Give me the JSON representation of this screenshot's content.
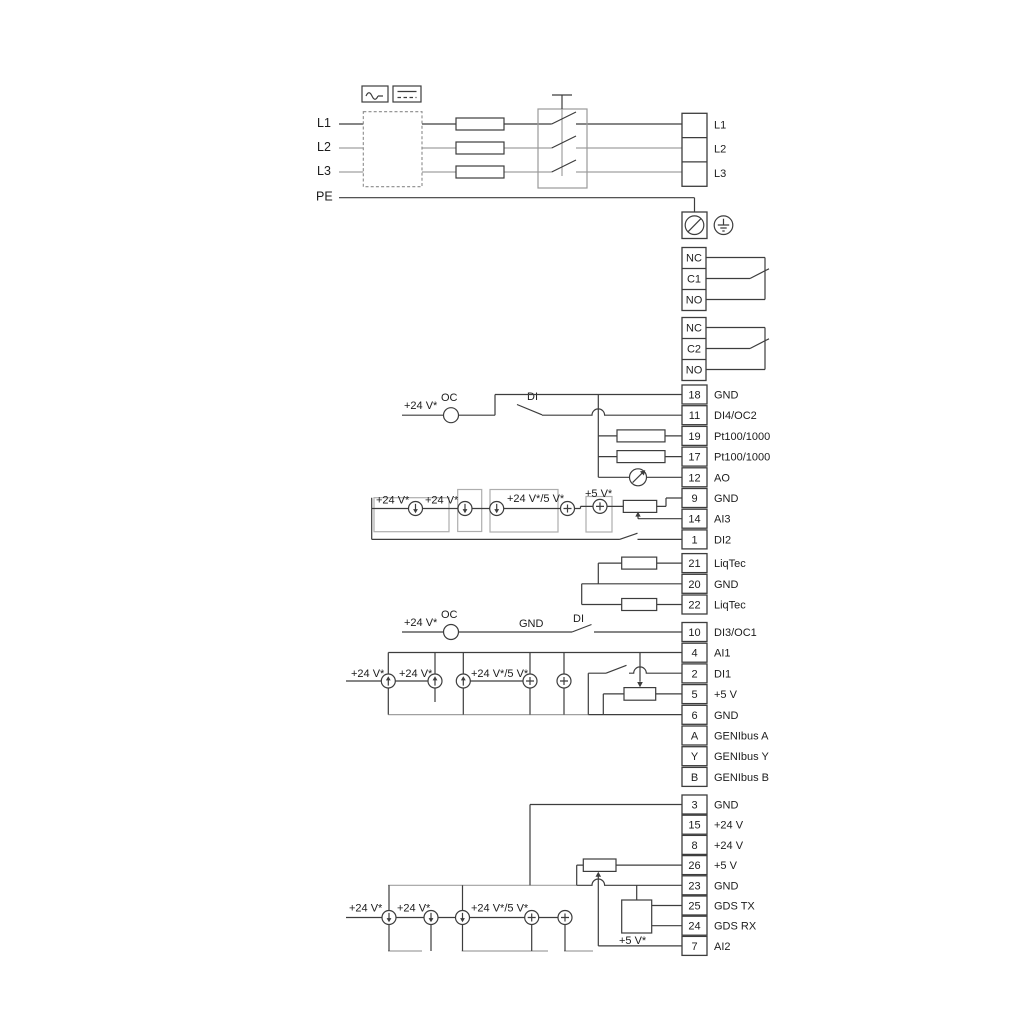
{
  "power": {
    "inputs": [
      "L1",
      "L2",
      "L3",
      "PE"
    ],
    "outputs": [
      "L1",
      "L2",
      "L3"
    ]
  },
  "relays": [
    {
      "t": [
        "NC",
        "C1",
        "NO"
      ]
    },
    {
      "t": [
        "NC",
        "C2",
        "NO"
      ]
    }
  ],
  "terminal_groups": [
    {
      "rows": [
        {
          "num": "18",
          "label": "GND"
        },
        {
          "num": "11",
          "label": "DI4/OC2"
        },
        {
          "num": "19",
          "label": "Pt100/1000"
        },
        {
          "num": "17",
          "label": "Pt100/1000"
        },
        {
          "num": "12",
          "label": "AO"
        },
        {
          "num": "9",
          "label": "GND"
        },
        {
          "num": "14",
          "label": "AI3"
        },
        {
          "num": "1",
          "label": "DI2"
        }
      ]
    },
    {
      "rows": [
        {
          "num": "21",
          "label": "LiqTec"
        },
        {
          "num": "20",
          "label": "GND"
        },
        {
          "num": "22",
          "label": "LiqTec"
        }
      ]
    },
    {
      "rows": [
        {
          "num": "10",
          "label": "DI3/OC1"
        },
        {
          "num": "4",
          "label": "AI1"
        },
        {
          "num": "2",
          "label": "DI1"
        },
        {
          "num": "5",
          "label": "+5 V"
        },
        {
          "num": "6",
          "label": "GND"
        },
        {
          "num": "A",
          "label": "GENIbus A"
        },
        {
          "num": "Y",
          "label": "GENIbus Y"
        },
        {
          "num": "B",
          "label": "GENIbus B"
        }
      ]
    },
    {
      "rows": [
        {
          "num": "3",
          "label": "GND"
        },
        {
          "num": "15",
          "label": "+24 V"
        },
        {
          "num": "8",
          "label": "+24 V"
        },
        {
          "num": "26",
          "label": "+5 V"
        },
        {
          "num": "23",
          "label": "GND"
        },
        {
          "num": "25",
          "label": "GDS TX"
        },
        {
          "num": "24",
          "label": "GDS RX"
        },
        {
          "num": "7",
          "label": "AI2"
        }
      ]
    }
  ],
  "sections": {
    "di4": {
      "v24": "+24 V*",
      "oc": "OC",
      "di": "DI"
    },
    "ai3": {
      "v24a": "+24 V*",
      "v24b": "+24 V*",
      "combo": "+24 V*/5 V*",
      "v5": "+5 V*"
    },
    "di3": {
      "v24": "+24 V*",
      "oc": "OC",
      "gnd": "GND",
      "di": "DI"
    },
    "ai1": {
      "v24a": "+24 V*",
      "v24b": "+24 V*",
      "combo": "+24 V*/5 V*"
    },
    "ai2": {
      "v24a": "+24 V*",
      "v24b": "+24 V*",
      "combo": "+24 V*/5 V*",
      "v5": "+5 V*"
    }
  },
  "colors": {
    "stroke_main": "#3d3d3d",
    "stroke_light": "#a0a0a0",
    "background": "#ffffff"
  }
}
